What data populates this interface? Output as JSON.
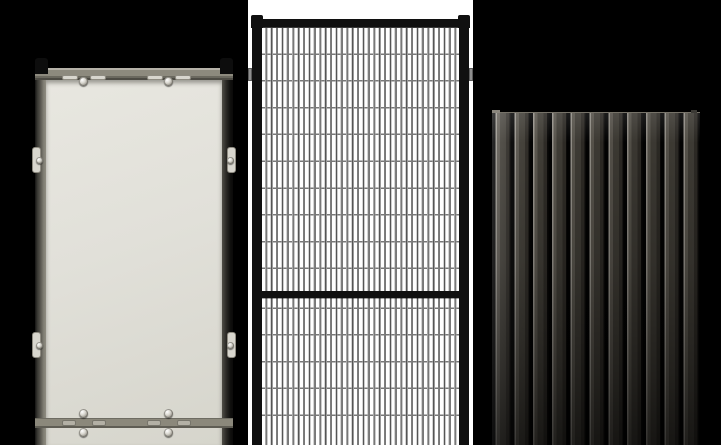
{
  "colors": {
    "page_bg": "#000000",
    "mid_section_bg": "#ffffff",
    "solid_infill": "#e1e0d9",
    "solid_infill_light": "#e8e7e0",
    "solid_infill_dark": "#d6d5cc",
    "solid_frame": "#8d8a7e",
    "solid_frame_light": "#b5b2a8",
    "solid_frame_dark": "#4e4c45",
    "hardware_metal": "#d8d6ce",
    "cap_black": "#0d0d0d",
    "mesh_frame": "#101010",
    "mesh_wire_dark": "#555555",
    "mesh_wire_light": "#a8a8a8",
    "mesh_wire_horizontal": "#777777",
    "rib_groove": "#020202",
    "rib_highlight": "#96928a",
    "rib_face": "#403d36",
    "rib_face_dark": "#2e2b26"
  },
  "panels": [
    {
      "name": "solid-infill-guard-panel",
      "description": "Grey-framed guard panel with solid light-grey infill sheet, black corner caps, side and top mounting clips with screws, and a lower horizontal rail with clip plates"
    },
    {
      "name": "wire-mesh-guard-panel",
      "description": "Black-framed wire mesh guard panel on white background, two mesh sections separated by a mid rail, small side fixing tabs"
    },
    {
      "name": "ribbed-sheet-panel",
      "description": "Dark anthracite vertical trapezoidal profiled steel sheet with highlighted rib edges, darkening toward the bottom"
    }
  ]
}
